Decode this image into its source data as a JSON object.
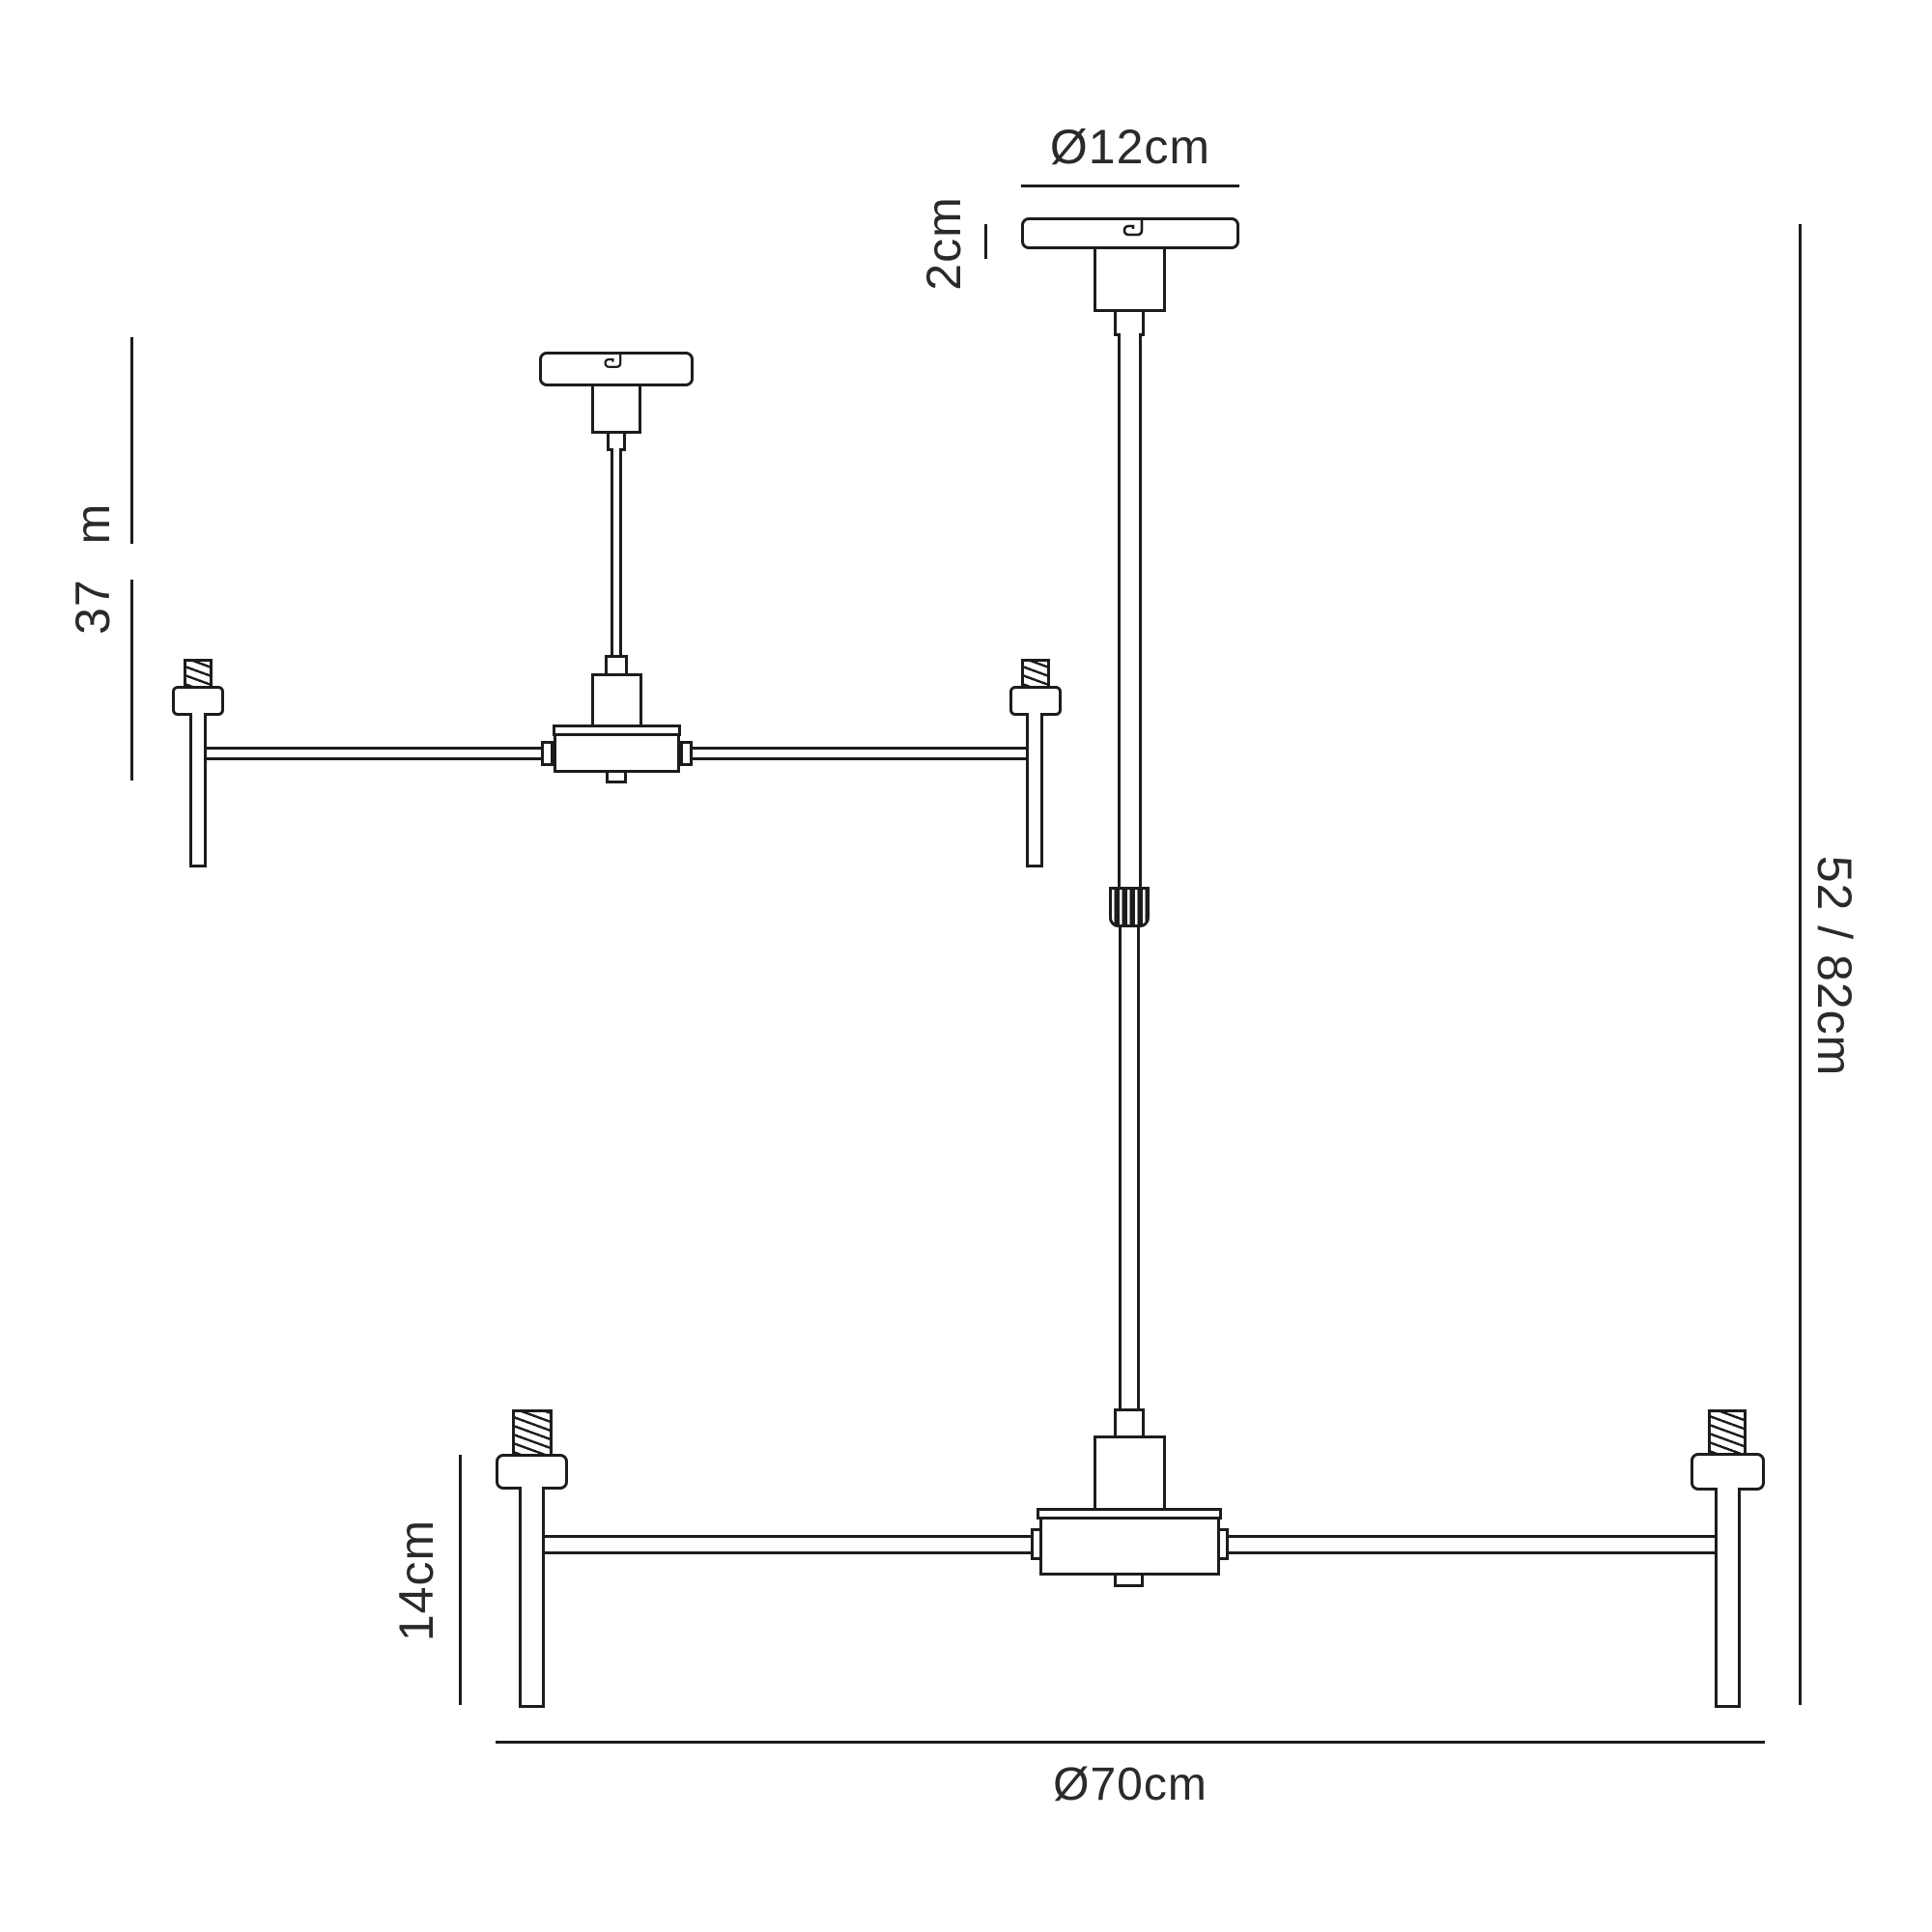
{
  "colors": {
    "ink": "#1c1c1c",
    "text": "#2a2a2a",
    "background": "#ffffff"
  },
  "diagram": {
    "type": "lighting-fixture-dimension-drawing",
    "views": [
      {
        "name": "semi-flush-version",
        "lights_visible": 2
      },
      {
        "name": "pendant-version",
        "lights_visible": 2
      }
    ]
  },
  "dims": {
    "canopy_diameter": "Ø12cm",
    "canopy_height": "2cm",
    "semi_flush_height": {
      "value": "37",
      "unit": "m"
    },
    "pendant_height": "52 / 82cm",
    "candle_height": "14cm",
    "fixture_diameter": "Ø70cm"
  }
}
